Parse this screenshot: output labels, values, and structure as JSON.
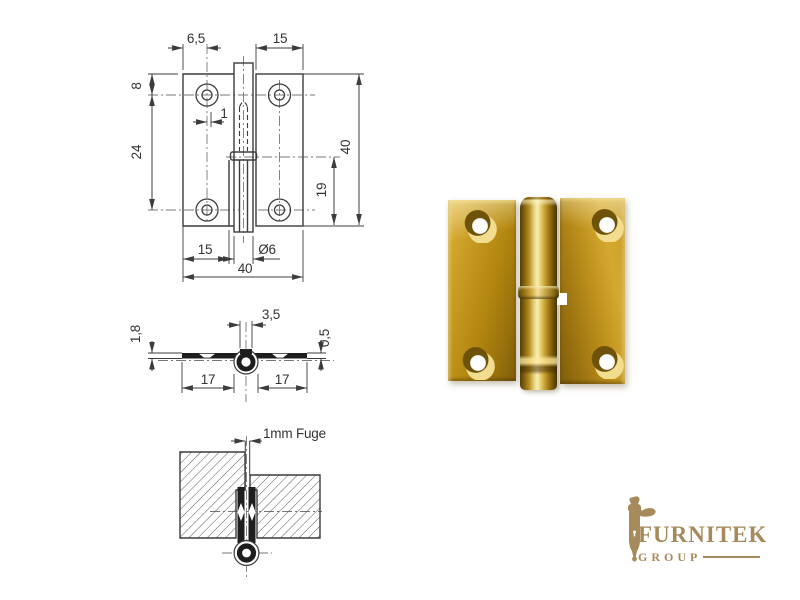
{
  "drawing": {
    "line_color": "#3c3c3c",
    "front_view": {
      "dim_top_left": "6,5",
      "dim_top_right": "15",
      "dim_edge_to_hole": "8",
      "dim_hole_spacing": "24",
      "dim_pin_offset": "1",
      "dim_total_height": "40",
      "dim_collar_to_bottom": "19",
      "dim_leaf_width": "15",
      "dim_pin_diameter": "Ø6",
      "dim_total_width": "40"
    },
    "section_view": {
      "dim_knuckle_width": "3,5",
      "dim_material_thickness": "1,8",
      "dim_edge_thickness": "0,5",
      "dim_left_leaf": "17",
      "dim_right_leaf": "17"
    },
    "detail_view": {
      "dim_gap": "1mm Fuge"
    }
  },
  "photo": {
    "brass_color": "#c49a24"
  },
  "logo": {
    "name": "FURNITEK",
    "group": "GROUP",
    "color": "#a78a5c"
  }
}
